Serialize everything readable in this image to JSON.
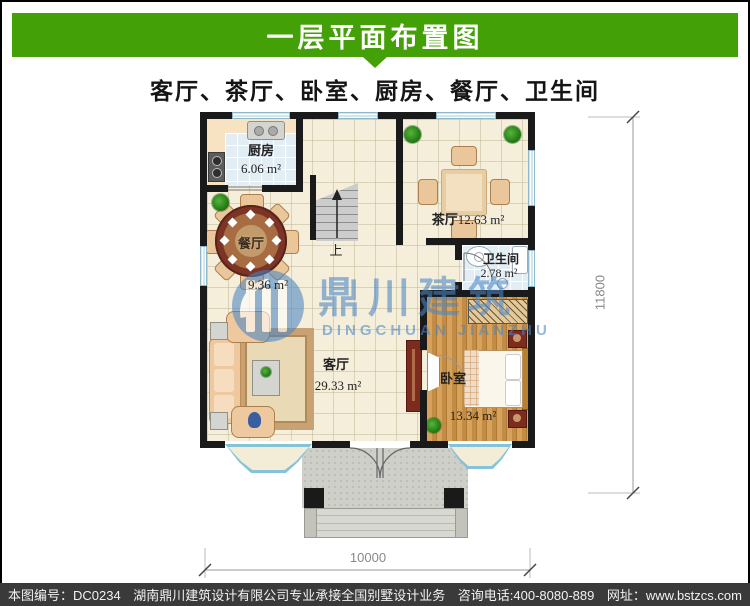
{
  "header": {
    "title": "一层平面布置图",
    "subtitle": "客厅、茶厅、卧室、厨房、餐厅、卫生间"
  },
  "plan": {
    "rooms": {
      "kitchen": {
        "name": "厨房",
        "area": "6.06 m²"
      },
      "dining": {
        "name": "餐厅",
        "area": "9.36 m²"
      },
      "tea": {
        "name": "茶厅",
        "area": "12.63 m²"
      },
      "bathroom": {
        "name": "卫生间",
        "area": "2.78 m²"
      },
      "living": {
        "name": "客厅",
        "area": "29.33 m²"
      },
      "bedroom": {
        "name": "卧室",
        "area": "13.34 m²"
      }
    },
    "stairs_label": "上",
    "dim_width": "10000",
    "dim_height": "11800"
  },
  "watermark": {
    "cn": "鼎川建筑",
    "en": "DINGCHUAN JIANZHU"
  },
  "footer": {
    "plan_no": "本图编号：DC0234",
    "company": "湖南鼎川建筑设计有限公司专业承接全国别墅设计业务",
    "phone": "咨询电话:400-8080-889",
    "website": "网址：www.bstzcs.com"
  },
  "colors": {
    "accent_green": "#43a006",
    "footer_bg": "#3a3a3a",
    "watermark_blue": "#4a86c4",
    "wall": "#1a1a1a"
  }
}
